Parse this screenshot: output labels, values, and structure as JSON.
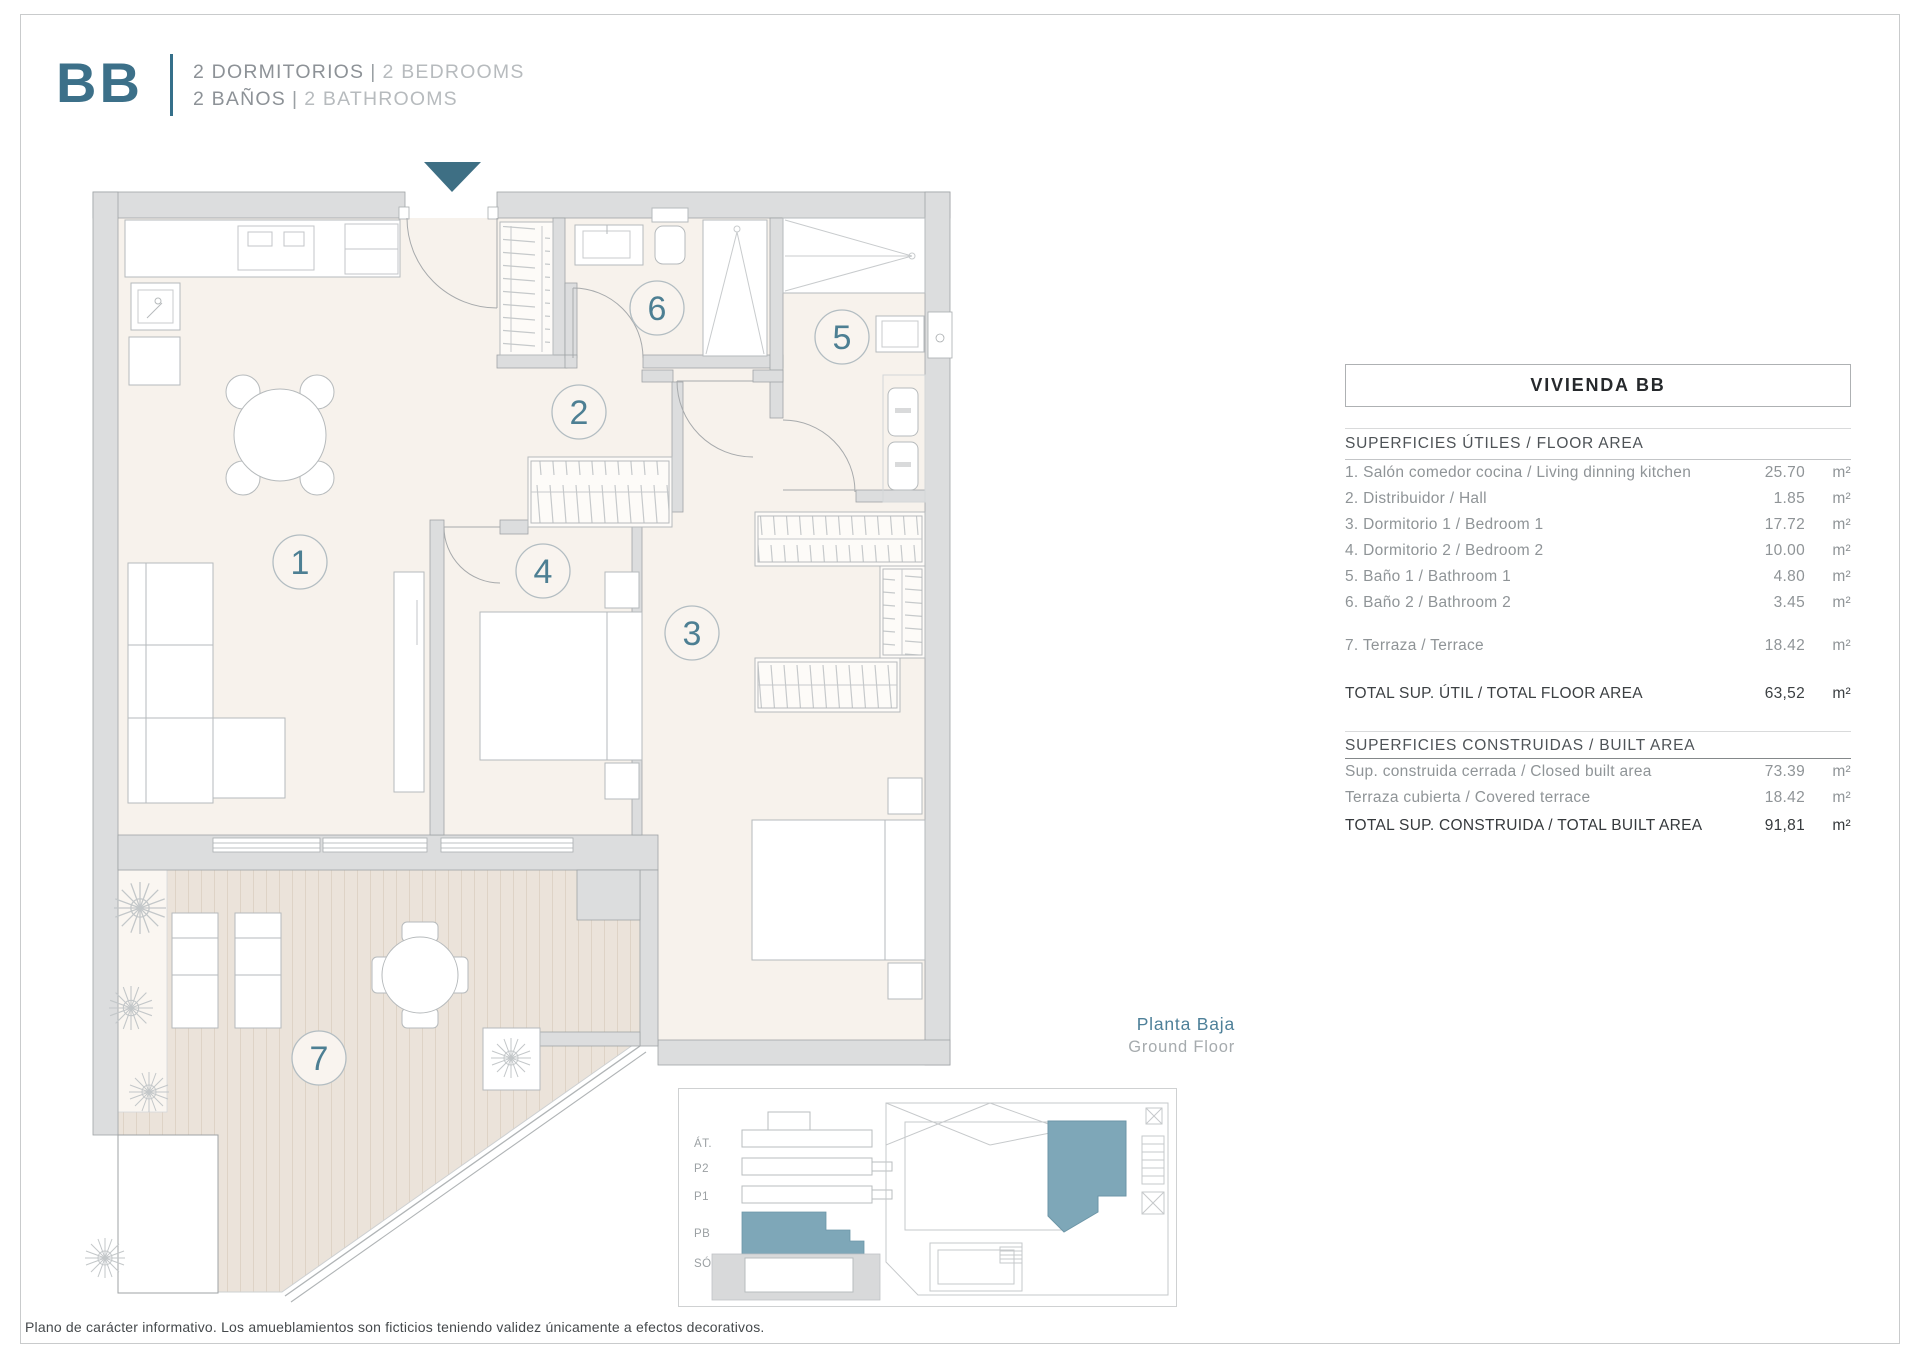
{
  "header": {
    "unit_code": "BB",
    "separator": "|",
    "bedrooms_es": "2 DORMITORIOS",
    "bedrooms_en": "2 BEDROOMS",
    "bathrooms_es": "2 BAÑOS",
    "bathrooms_en": "2 BATHROOMS"
  },
  "plan": {
    "room_numbers": [
      "1",
      "2",
      "3",
      "4",
      "5",
      "6",
      "7"
    ]
  },
  "area_table": {
    "title": "VIVIENDA BB",
    "useful": {
      "header": "SUPERFICIES ÚTILES / FLOOR AREA",
      "rows": [
        {
          "label": "1. Salón comedor cocina / Living dinning kitchen",
          "value": "25.70",
          "unit": "m²"
        },
        {
          "label": "2. Distribuidor / Hall",
          "value": "1.85",
          "unit": "m²"
        },
        {
          "label": "3. Dormitorio 1 / Bedroom 1",
          "value": "17.72",
          "unit": "m²"
        },
        {
          "label": "4. Dormitorio 2 / Bedroom 2",
          "value": "10.00",
          "unit": "m²"
        },
        {
          "label": "5. Baño 1 / Bathroom 1",
          "value": "4.80",
          "unit": "m²"
        },
        {
          "label": "6. Baño 2 / Bathroom 2",
          "value": "3.45",
          "unit": "m²"
        }
      ],
      "terrace_row": {
        "label": "7. Terraza / Terrace",
        "value": "18.42",
        "unit": "m²"
      },
      "total": {
        "label": "TOTAL SUP. ÚTIL / TOTAL FLOOR AREA",
        "value": "63,52",
        "unit": "m²"
      }
    },
    "built": {
      "header": "SUPERFICIES CONSTRUIDAS / BUILT AREA",
      "rows": [
        {
          "label": "Sup. construida cerrada / Closed built area",
          "value": "73.39",
          "unit": "m²"
        },
        {
          "label": "Terraza cubierta / Covered terrace",
          "value": "18.42",
          "unit": "m²"
        }
      ],
      "total": {
        "label": "TOTAL SUP. CONSTRUIDA /  TOTAL BUILT AREA",
        "value": "91,81",
        "unit": "m²"
      }
    }
  },
  "floor_label": {
    "es": "Planta Baja",
    "en": "Ground Floor"
  },
  "levels": [
    "ÁT.",
    "P2",
    "P1",
    "PB",
    "SÓT."
  ],
  "disclaimer": "Plano de carácter informativo. Los amueblamientos son ficticios teniendo validez únicamente a efectos decorativos.",
  "colors": {
    "accent": "#3E7286",
    "highlight": "#7EA7B8"
  }
}
